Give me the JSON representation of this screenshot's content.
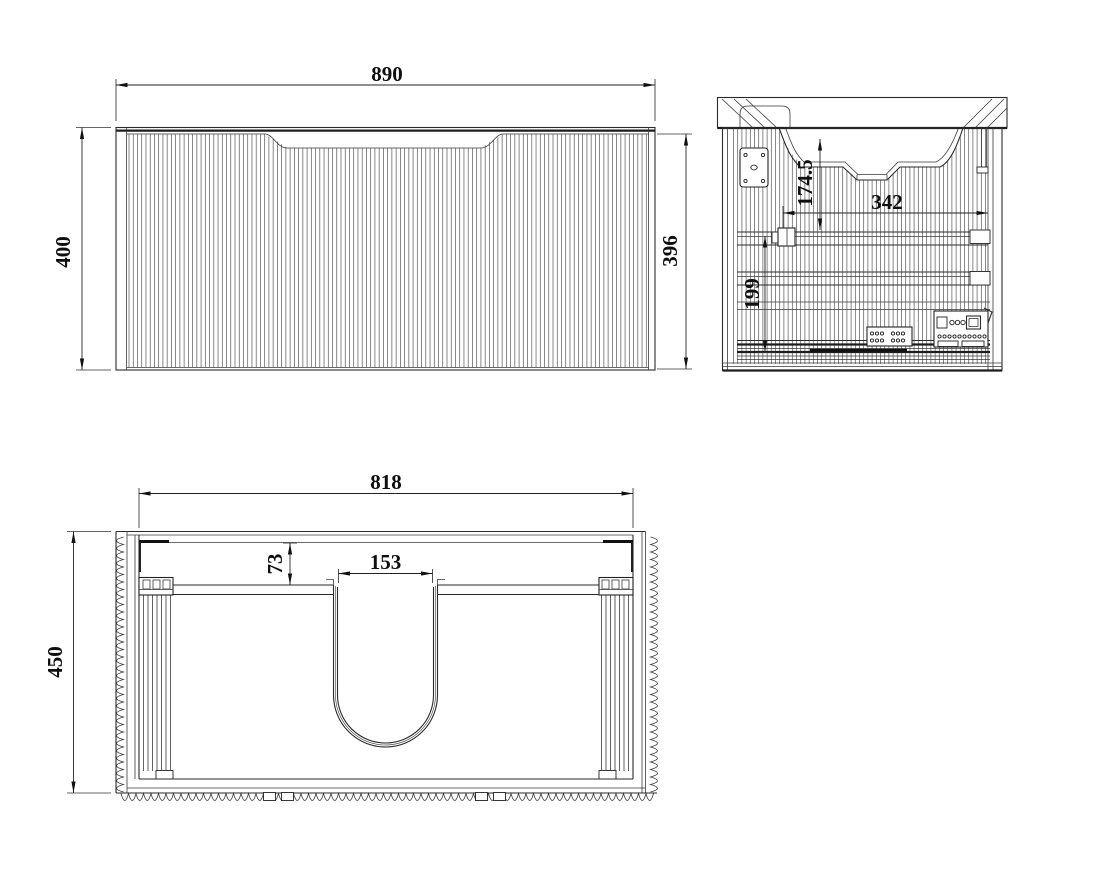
{
  "document": {
    "kind": "cad-technical-drawing",
    "subject": "wall-hung vanity cabinet with basin",
    "colors": {
      "background": "#ffffff",
      "line": "#2a2a2a",
      "flute": "#565656",
      "text": "#0f0f0f"
    },
    "views": {
      "front": {
        "dimensions": {
          "width": "890",
          "height_left": "400",
          "height_right": "396"
        }
      },
      "side": {
        "dimensions": {
          "basin_depth": "174.5",
          "rail_span": "342",
          "drawer_zone": "199"
        }
      },
      "plan": {
        "dimensions": {
          "inner_width": "818",
          "back_offset": "73",
          "cutout_width": "153",
          "depth": "450"
        }
      }
    }
  }
}
